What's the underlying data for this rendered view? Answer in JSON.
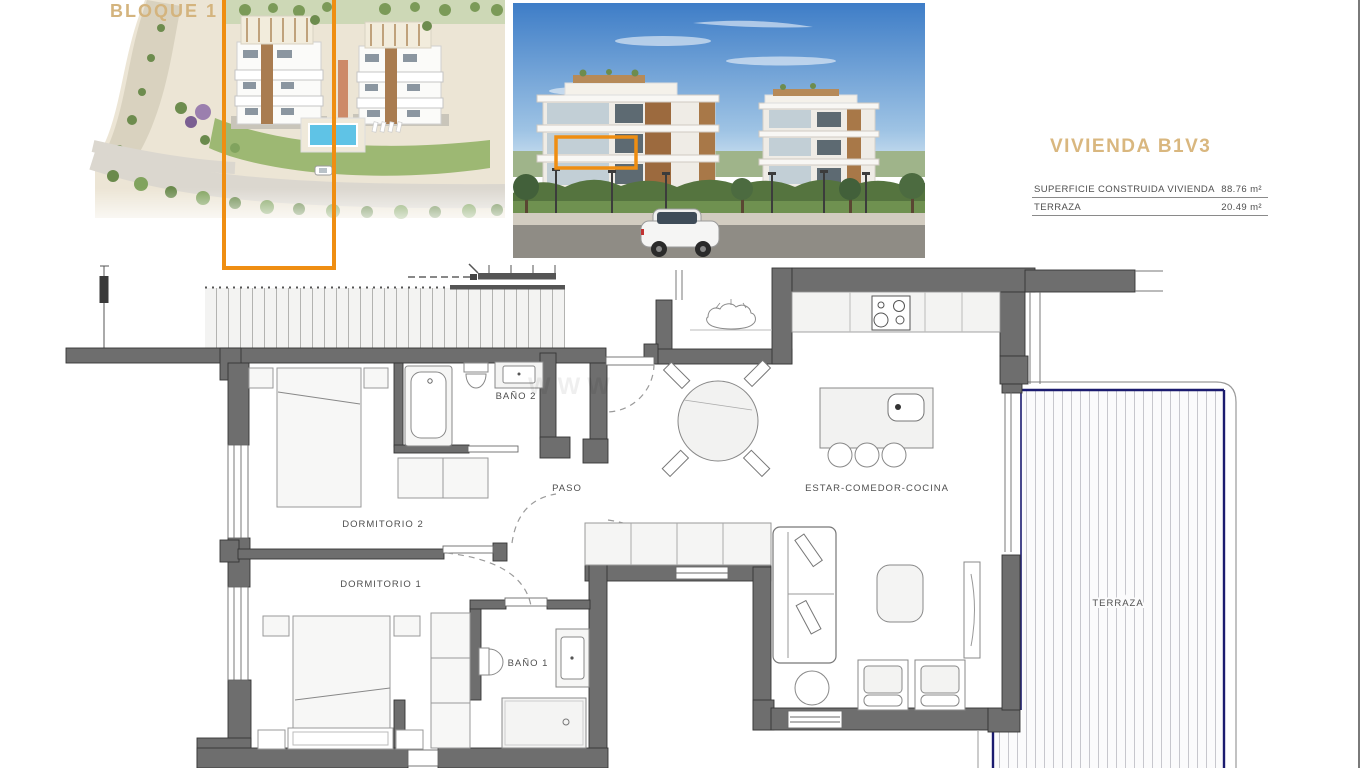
{
  "aerial": {
    "bloque_label": "BLOQUE 1"
  },
  "info": {
    "title": "VIVIENDA B1V3",
    "rows": [
      {
        "label": "SUPERFICIE CONSTRUIDA VIVIENDA",
        "value": "88.76 m²"
      },
      {
        "label": "TERRAZA",
        "value": "20.49 m²"
      }
    ]
  },
  "floorplan": {
    "rooms": {
      "bano2": "BAÑO 2",
      "paso": "PASO",
      "dormitorio2": "DORMITORIO 2",
      "dormitorio1": "DORMITORIO 1",
      "bano1": "BAÑO 1",
      "estar": "ESTAR-COMEDOR-COCINA",
      "terraza": "TERRAZA"
    },
    "watermark": "WWW"
  },
  "colors": {
    "accent_orange": "#EF8E12",
    "title_tan": "#D9B77F",
    "wall_gray": "#6E6E6E",
    "terrace_navy": "#1B1B6F"
  }
}
